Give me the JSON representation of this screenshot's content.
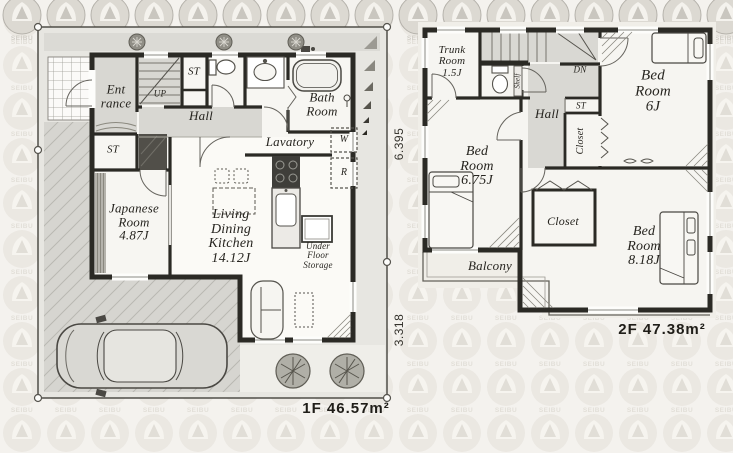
{
  "watermark": {
    "brand": "SEIBU"
  },
  "floor1": {
    "area_label": "1F 46.57m²",
    "dim_upper": "6.395",
    "dim_lower": "3.318",
    "labels": {
      "entrance": "Ent\nrance",
      "up": "UP",
      "st_upper": "ST",
      "hall": "Hall",
      "bath": "Bath\nRoom",
      "lavatory": "Lavatory",
      "washer": "W",
      "fridge": "R",
      "st_lower": "ST",
      "japanese": "Japanese\nRoom\n4.87J",
      "ldk": "Living\nDining\nKitchen\n14.12J",
      "under_floor": "Under\nFloor\nStorage"
    }
  },
  "floor2": {
    "area_label": "2F 47.38m²",
    "labels": {
      "trunk": "Trunk\nRoom\n1.5J",
      "dn": "DN",
      "shelf": "Shelf",
      "hall": "Hall",
      "st": "ST",
      "closet_upper": "Closet",
      "bed6": "Bed\nRoom\n6J",
      "bed675": "Bed\nRoom\n6.75J",
      "closet_lower": "Closet",
      "bed818": "Bed\nRoom\n8.18J",
      "balcony": "Balcony"
    }
  }
}
